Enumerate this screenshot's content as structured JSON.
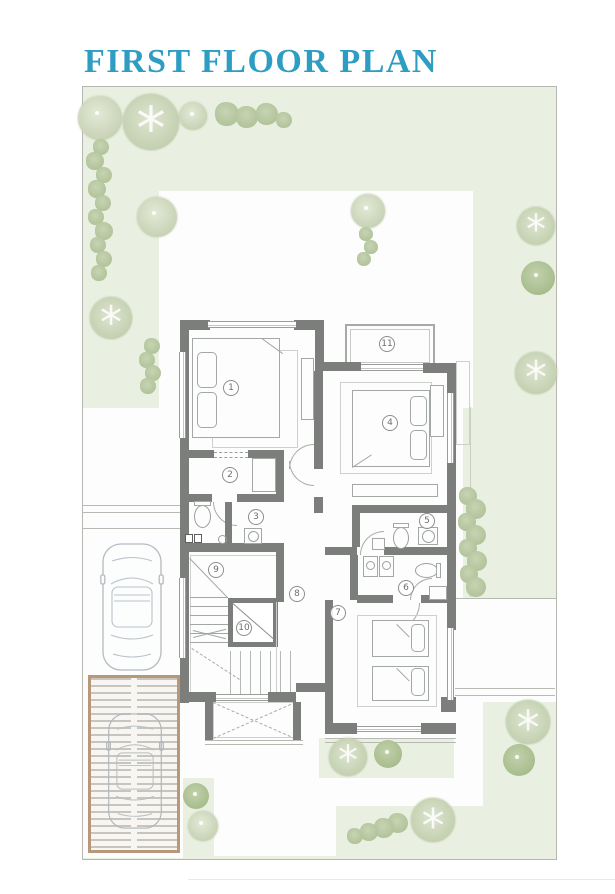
{
  "title": "FIRST FLOOR PLAN",
  "colors": {
    "accent": "#2e9dc3",
    "wall": "#7c7e7b",
    "site_green": "#eaf0e1",
    "tree_green": "#c3d0ad",
    "deck_border": "#b79878"
  },
  "plan": {
    "room_numbers": [
      {
        "n": "1",
        "x": 231,
        "y": 388
      },
      {
        "n": "2",
        "x": 230,
        "y": 475
      },
      {
        "n": "3",
        "x": 256,
        "y": 517
      },
      {
        "n": "4",
        "x": 390,
        "y": 423
      },
      {
        "n": "5",
        "x": 427,
        "y": 521
      },
      {
        "n": "6",
        "x": 406,
        "y": 588
      },
      {
        "n": "7",
        "x": 338,
        "y": 613
      },
      {
        "n": "8",
        "x": 297,
        "y": 594
      },
      {
        "n": "9",
        "x": 216,
        "y": 570
      },
      {
        "n": "10",
        "x": 244,
        "y": 628
      },
      {
        "n": "11",
        "x": 387,
        "y": 344
      }
    ]
  },
  "site": {
    "trees": [
      {
        "x": 100,
        "y": 118,
        "r": 22,
        "t": "plain"
      },
      {
        "x": 151,
        "y": 122,
        "r": 28,
        "t": "detail"
      },
      {
        "x": 193,
        "y": 116,
        "r": 14,
        "t": "plain"
      },
      {
        "x": 227,
        "y": 114,
        "r": 12,
        "t": "shrub"
      },
      {
        "x": 247,
        "y": 117,
        "r": 11,
        "t": "shrub"
      },
      {
        "x": 267,
        "y": 114,
        "r": 11,
        "t": "shrub"
      },
      {
        "x": 284,
        "y": 120,
        "r": 8,
        "t": "shrub"
      },
      {
        "x": 101,
        "y": 147,
        "r": 8,
        "t": "shrub"
      },
      {
        "x": 95,
        "y": 161,
        "r": 9,
        "t": "shrub"
      },
      {
        "x": 104,
        "y": 175,
        "r": 8,
        "t": "shrub"
      },
      {
        "x": 97,
        "y": 189,
        "r": 9,
        "t": "shrub"
      },
      {
        "x": 103,
        "y": 203,
        "r": 8,
        "t": "shrub"
      },
      {
        "x": 96,
        "y": 217,
        "r": 8,
        "t": "shrub"
      },
      {
        "x": 104,
        "y": 231,
        "r": 9,
        "t": "shrub"
      },
      {
        "x": 98,
        "y": 245,
        "r": 8,
        "t": "shrub"
      },
      {
        "x": 104,
        "y": 259,
        "r": 8,
        "t": "shrub"
      },
      {
        "x": 99,
        "y": 273,
        "r": 8,
        "t": "shrub"
      },
      {
        "x": 157,
        "y": 217,
        "r": 20,
        "t": "plain"
      },
      {
        "x": 111,
        "y": 318,
        "r": 21,
        "t": "detail"
      },
      {
        "x": 368,
        "y": 211,
        "r": 17,
        "t": "plain"
      },
      {
        "x": 366,
        "y": 234,
        "r": 7,
        "t": "shrub"
      },
      {
        "x": 371,
        "y": 247,
        "r": 7,
        "t": "shrub"
      },
      {
        "x": 364,
        "y": 259,
        "r": 7,
        "t": "shrub"
      },
      {
        "x": 152,
        "y": 346,
        "r": 8,
        "t": "shrub"
      },
      {
        "x": 147,
        "y": 360,
        "r": 8,
        "t": "shrub"
      },
      {
        "x": 153,
        "y": 373,
        "r": 8,
        "t": "shrub"
      },
      {
        "x": 148,
        "y": 386,
        "r": 8,
        "t": "shrub"
      },
      {
        "x": 536,
        "y": 226,
        "r": 19,
        "t": "detail"
      },
      {
        "x": 538,
        "y": 278,
        "r": 17,
        "t": "dark"
      },
      {
        "x": 536,
        "y": 373,
        "r": 21,
        "t": "detail"
      },
      {
        "x": 468,
        "y": 496,
        "r": 9,
        "t": "shrub"
      },
      {
        "x": 476,
        "y": 509,
        "r": 10,
        "t": "shrub"
      },
      {
        "x": 467,
        "y": 522,
        "r": 9,
        "t": "shrub"
      },
      {
        "x": 476,
        "y": 535,
        "r": 10,
        "t": "shrub"
      },
      {
        "x": 468,
        "y": 548,
        "r": 9,
        "t": "shrub"
      },
      {
        "x": 477,
        "y": 561,
        "r": 10,
        "t": "shrub"
      },
      {
        "x": 469,
        "y": 574,
        "r": 9,
        "t": "shrub"
      },
      {
        "x": 476,
        "y": 587,
        "r": 10,
        "t": "shrub"
      },
      {
        "x": 528,
        "y": 722,
        "r": 22,
        "t": "detail"
      },
      {
        "x": 519,
        "y": 760,
        "r": 16,
        "t": "dark"
      },
      {
        "x": 433,
        "y": 820,
        "r": 22,
        "t": "detail"
      },
      {
        "x": 398,
        "y": 823,
        "r": 10,
        "t": "shrub"
      },
      {
        "x": 384,
        "y": 828,
        "r": 10,
        "t": "shrub"
      },
      {
        "x": 369,
        "y": 832,
        "r": 9,
        "t": "shrub"
      },
      {
        "x": 355,
        "y": 836,
        "r": 8,
        "t": "shrub"
      },
      {
        "x": 348,
        "y": 757,
        "r": 19,
        "t": "detail"
      },
      {
        "x": 388,
        "y": 754,
        "r": 14,
        "t": "dark"
      },
      {
        "x": 196,
        "y": 796,
        "r": 13,
        "t": "dark"
      },
      {
        "x": 203,
        "y": 826,
        "r": 15,
        "t": "plain"
      }
    ]
  }
}
